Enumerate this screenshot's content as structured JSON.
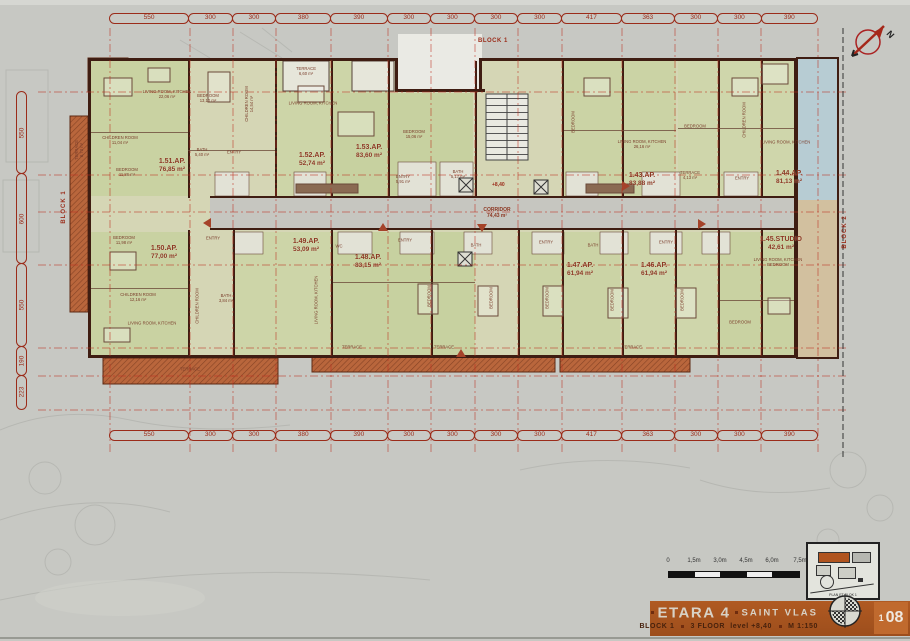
{
  "labels": {
    "block_top": "BLOCK 1",
    "block_left": "BLOCK 1",
    "block_right": "BLOCK 2",
    "compass": "N",
    "level_mark": "+8,40",
    "corridor": "CORRIDOR\n74,43 m²"
  },
  "dims": {
    "top": [
      "550",
      "300",
      "300",
      "380",
      "390",
      "300",
      "300",
      "300",
      "300",
      "417",
      "363",
      "300",
      "300",
      "390"
    ],
    "bottom": [
      "550",
      "300",
      "300",
      "380",
      "390",
      "300",
      "300",
      "300",
      "300",
      "417",
      "363",
      "300",
      "300",
      "390"
    ],
    "left": [
      "550",
      "600",
      "550",
      "190",
      "223"
    ]
  },
  "apartments": [
    {
      "id": "1.51.AP.",
      "area": "76,85 m²"
    },
    {
      "id": "1.52.AP.",
      "area": "52,74 m²"
    },
    {
      "id": "1.53.AP.",
      "area": "83,60 m²"
    },
    {
      "id": "1.43.AP.",
      "area": "83,88 m²"
    },
    {
      "id": "1.44.AP.",
      "area": "81,13 m²"
    },
    {
      "id": "1.45.STUDIO",
      "area": "42,61 m²"
    },
    {
      "id": "1.46.AP.",
      "area": "61,94 m²"
    },
    {
      "id": "1.47.AP.",
      "area": "61,94 m²"
    },
    {
      "id": "1.48.AP.",
      "area": "83,15 m²"
    },
    {
      "id": "1.49.AP.",
      "area": "53,09 m²"
    },
    {
      "id": "1.50.AP.",
      "area": "77,00 m²"
    }
  ],
  "rooms": [
    "TERRACE\n8,73 m²",
    "LIVING ROOM, KITCHEN\n22,06 m²",
    "BEDROOM\n13,10 m²",
    "CHILDREN ROOM\n14,54 m²",
    "CHILDREN ROOM\n11,04 m²",
    "BEDROOM\n11,86 m²",
    "BATH\n5,40 m²",
    "ENTRY",
    "TERRACE\n6,60 m²",
    "LIVING ROOM, KITCHEN",
    "BEDROOM\n15,06 m²",
    "ENTRY\n5,91 m²",
    "BATH\n5,17 m²",
    "BEDROOM",
    "LIVING ROOM, KITCHEN\n26,16 m²",
    "BEDROOM",
    "CHILDREN ROOM",
    "TERRACE\n4,13 m²",
    "ENTRY",
    "LIVING ROOM, KITCHEN",
    "BEDROOM\n11,98 m²",
    "ENTRY",
    "CHILDREN ROOM\n12,16 m²",
    "BATH\n3,84 m²",
    "LIVING ROOM, KITCHEN",
    "CHILDREN ROOM",
    "WC",
    "LIVING ROOM, KITCHEN",
    "BEDROOM",
    "BEDROOM",
    "BEDROOM",
    "BEDROOM",
    "BEDROOM",
    "ENTRY",
    "ENTRY",
    "ENTRY",
    "BATH",
    "BATH",
    "TERRACE",
    "TERRACE",
    "TERRACE",
    "TERRACE",
    "LIVING ROOM, KITCHEN\nBEDROOM",
    "BEDROOM"
  ],
  "scale_bar": {
    "labels": [
      "0",
      "1,5m",
      "3,0m",
      "4,5m",
      "6,0m",
      "7,5m"
    ]
  },
  "key_plan": {
    "caption": "PLAN ET BLOK 1"
  },
  "title_block": {
    "project": "ETARA 4",
    "location": "SAINT VLAS",
    "block": "BLOCK 1",
    "floor": "3 FLOOR",
    "level": "level +8,40",
    "scale": "M 1:150",
    "sheet_small": "1",
    "sheet_big": "08"
  },
  "colors": {
    "banner": "#a8541f",
    "terrace_hatch": "#b9663c",
    "dimension_red": "#9b2c1a",
    "wall": "#3f1d12",
    "room_green": "#ccd4ab",
    "blue_terrace": "#b7ccd3"
  }
}
